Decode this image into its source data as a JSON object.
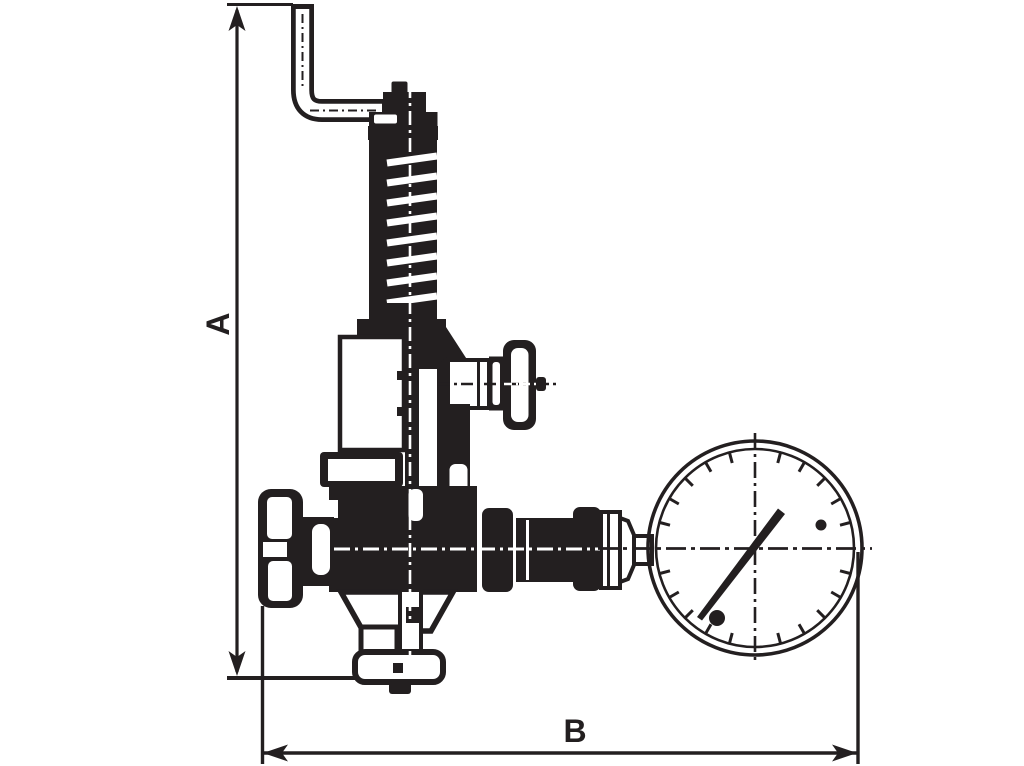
{
  "drawing": {
    "title": "safety-valve-with-pressure-gauge-dimension-drawing",
    "dimensions": {
      "vertical_label": "A",
      "horizontal_label": "B"
    },
    "colors": {
      "ink": "#231f20",
      "background": "#ffffff"
    },
    "gauge": {
      "cx": 755,
      "cy": 548,
      "outer_radius": 107,
      "inner_radius": 99,
      "tick_inner_radius": 88,
      "tick_outer_radius": 100,
      "tick_step_deg": 15,
      "needle_angle_deg": 53,
      "marker_dots": [
        {
          "x": 717,
          "y": 618,
          "r": 8
        },
        {
          "x": 821,
          "y": 525,
          "r": 5.5
        }
      ]
    },
    "spring": {
      "coil_gap_count": 8
    }
  }
}
